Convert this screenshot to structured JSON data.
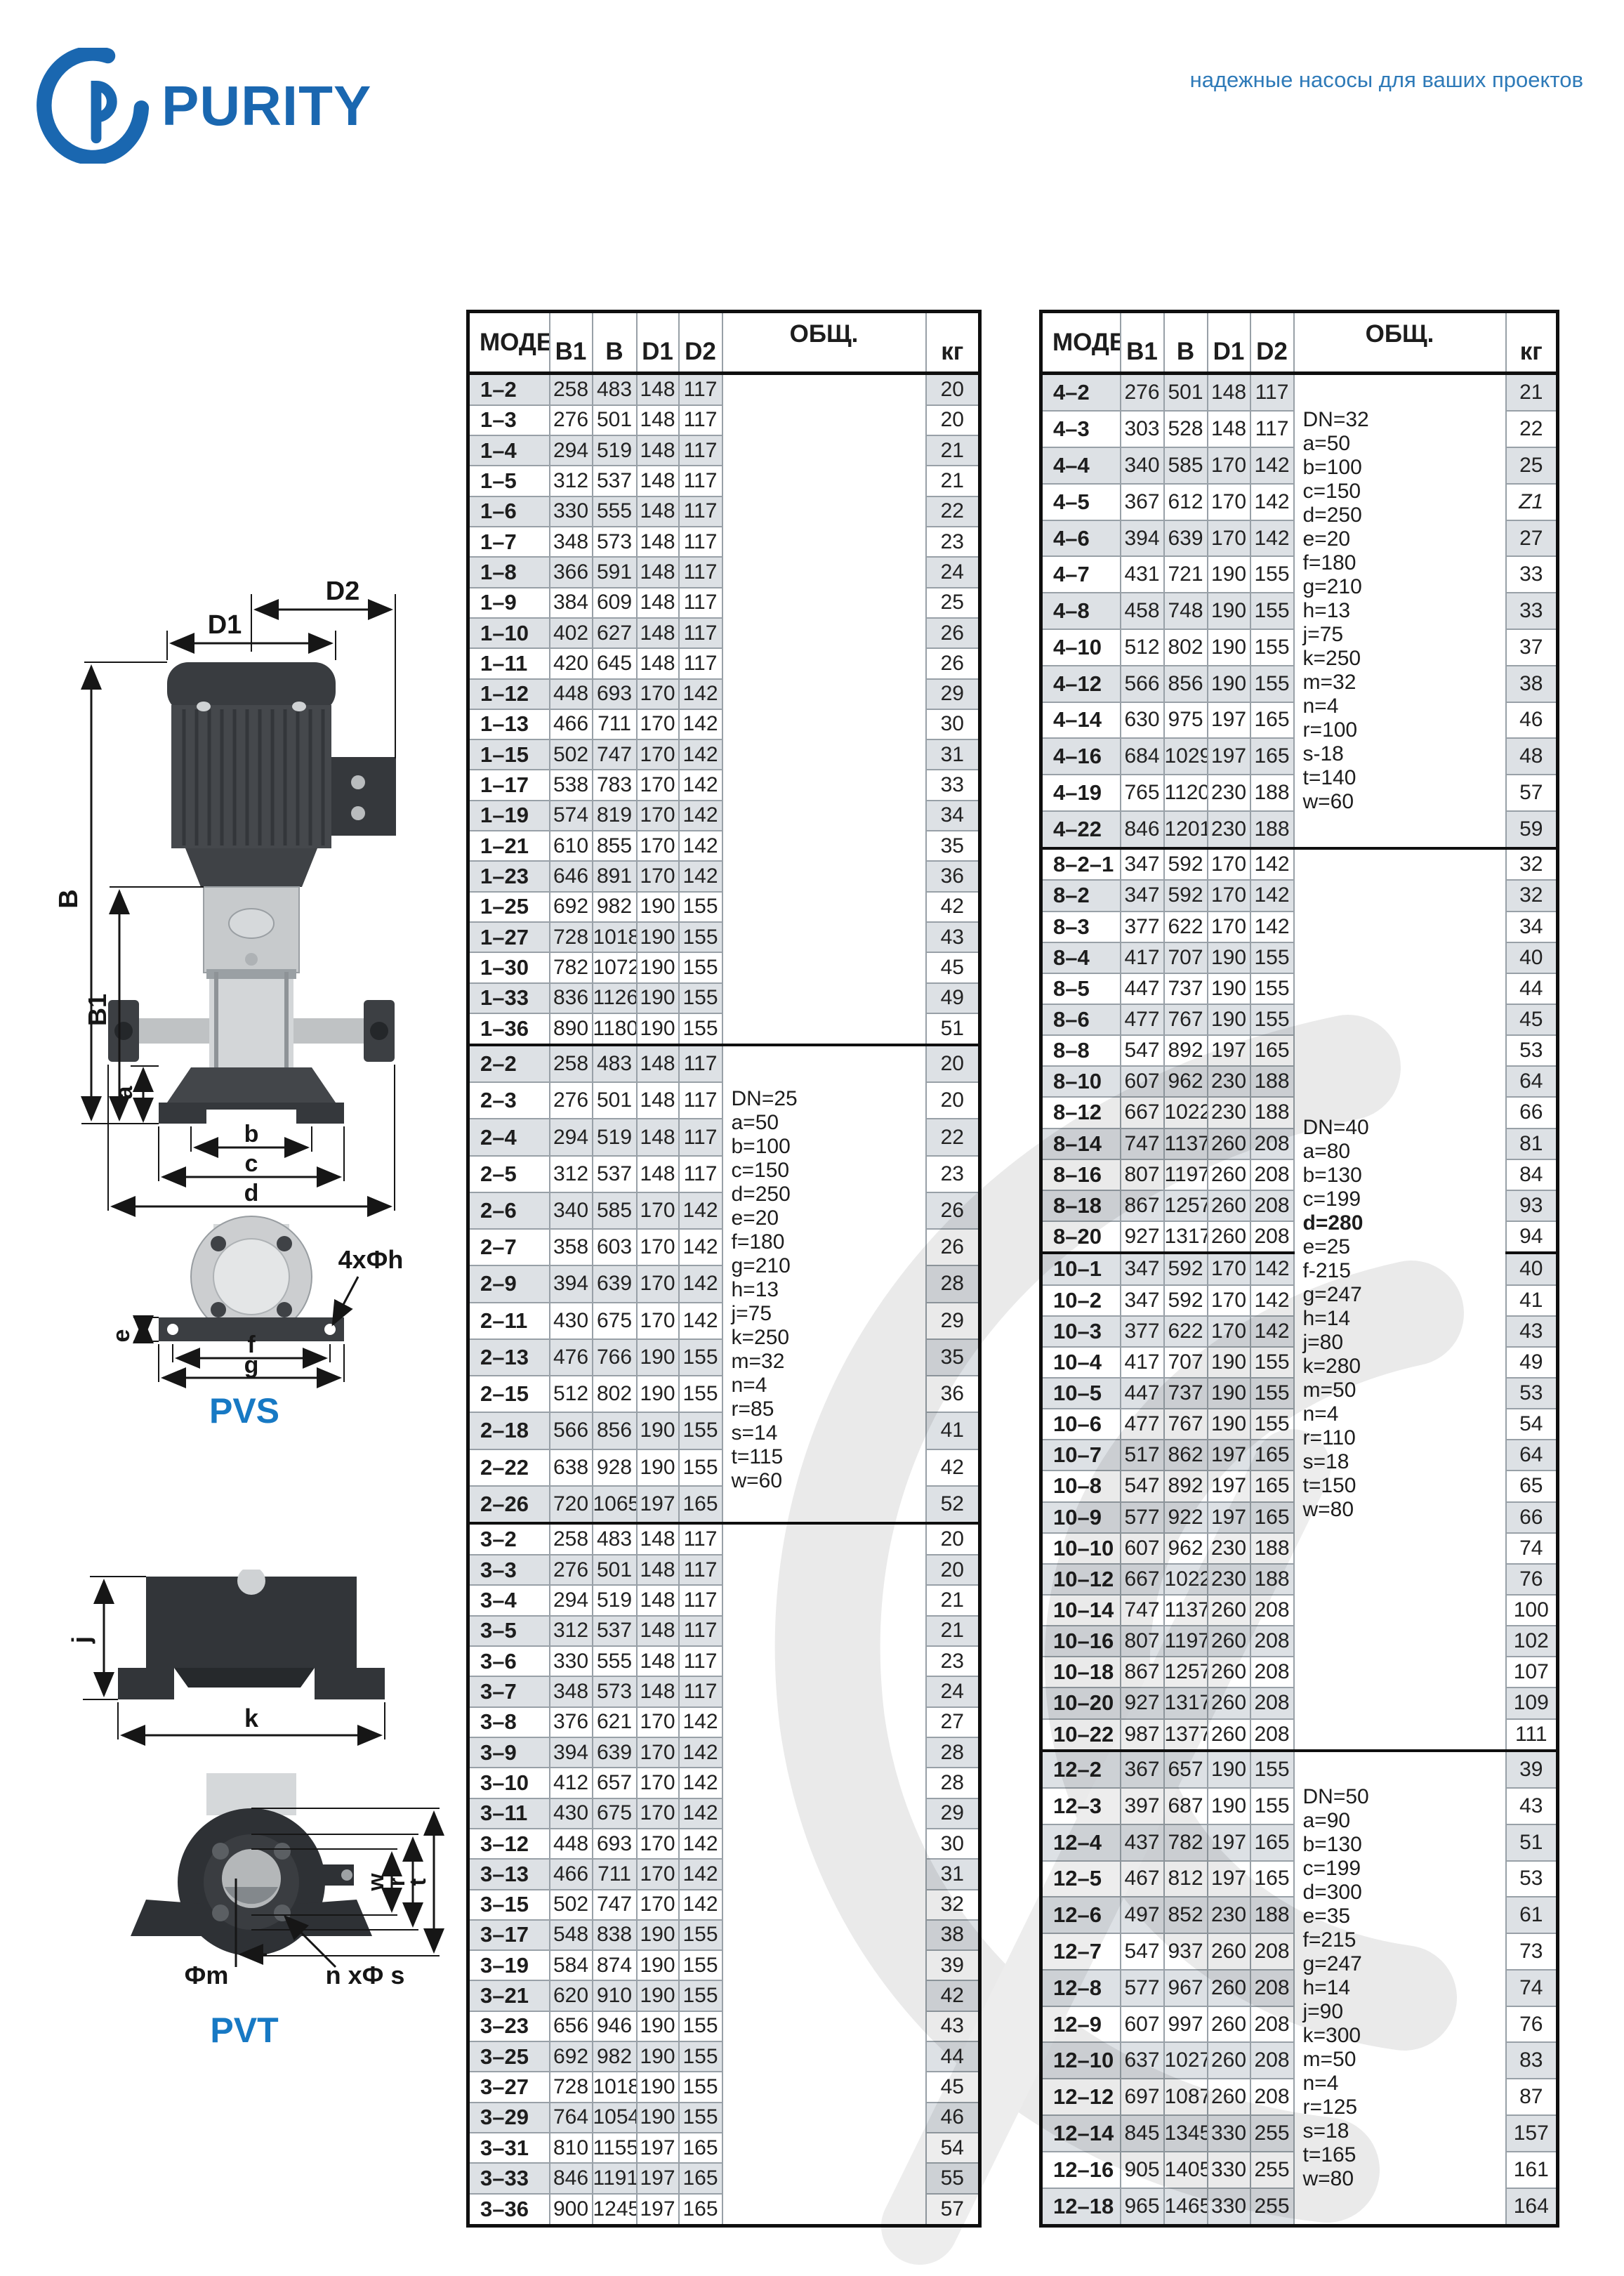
{
  "page": {
    "brand": "PURITY",
    "tagline": "надежные насосы для ваших проектов"
  },
  "diagram_labels": {
    "D1": "D1",
    "D2": "D2",
    "B": "B",
    "B1": "B1",
    "a": "a",
    "b": "b",
    "c": "c",
    "d": "d",
    "e": "e",
    "f": "f",
    "g": "g",
    "holes": "4xФh",
    "j": "j",
    "k": "k",
    "m": "Фm",
    "ns": "n xФ s",
    "w": "w",
    "r": "r",
    "t": "t",
    "pvs": "PVS",
    "pvt": "PVT"
  },
  "table_headers": {
    "model": "МОДЕЛЬ",
    "b1": "B1",
    "b": "B",
    "d1": "D1",
    "d2": "D2",
    "obsh": "ОБЩ.",
    "kg": "кг"
  },
  "left_table": {
    "groups": [
      {
        "rows": [
          [
            "1–2",
            "258",
            "483",
            "148",
            "117",
            "20"
          ],
          [
            "1–3",
            "276",
            "501",
            "148",
            "117",
            "20"
          ],
          [
            "1–4",
            "294",
            "519",
            "148",
            "117",
            "21"
          ],
          [
            "1–5",
            "312",
            "537",
            "148",
            "117",
            "21"
          ],
          [
            "1–6",
            "330",
            "555",
            "148",
            "117",
            "22"
          ],
          [
            "1–7",
            "348",
            "573",
            "148",
            "117",
            "23"
          ],
          [
            "1–8",
            "366",
            "591",
            "148",
            "117",
            "24"
          ],
          [
            "1–9",
            "384",
            "609",
            "148",
            "117",
            "25"
          ],
          [
            "1–10",
            "402",
            "627",
            "148",
            "117",
            "26"
          ],
          [
            "1–11",
            "420",
            "645",
            "148",
            "117",
            "26"
          ],
          [
            "1–12",
            "448",
            "693",
            "170",
            "142",
            "29"
          ],
          [
            "1–13",
            "466",
            "711",
            "170",
            "142",
            "30"
          ],
          [
            "1–15",
            "502",
            "747",
            "170",
            "142",
            "31"
          ],
          [
            "1–17",
            "538",
            "783",
            "170",
            "142",
            "33"
          ],
          [
            "1–19",
            "574",
            "819",
            "170",
            "142",
            "34"
          ],
          [
            "1–21",
            "610",
            "855",
            "170",
            "142",
            "35"
          ],
          [
            "1–23",
            "646",
            "891",
            "170",
            "142",
            "36"
          ],
          [
            "1–25",
            "692",
            "982",
            "190",
            "155",
            "42"
          ],
          [
            "1–27",
            "728",
            "1018",
            "190",
            "155",
            "43"
          ],
          [
            "1–30",
            "782",
            "1072",
            "190",
            "155",
            "45"
          ],
          [
            "1–33",
            "836",
            "1126",
            "190",
            "155",
            "49"
          ],
          [
            "1–36",
            "890",
            "1180",
            "190",
            "155",
            "51"
          ]
        ]
      },
      {
        "rows": [
          [
            "2–2",
            "258",
            "483",
            "148",
            "117",
            "20"
          ],
          [
            "2–3",
            "276",
            "501",
            "148",
            "117",
            "20"
          ],
          [
            "2–4",
            "294",
            "519",
            "148",
            "117",
            "22"
          ],
          [
            "2–5",
            "312",
            "537",
            "148",
            "117",
            "23"
          ],
          [
            "2–6",
            "340",
            "585",
            "170",
            "142",
            "26"
          ],
          [
            "2–7",
            "358",
            "603",
            "170",
            "142",
            "26"
          ],
          [
            "2–9",
            "394",
            "639",
            "170",
            "142",
            "28"
          ],
          [
            "2–11",
            "430",
            "675",
            "170",
            "142",
            "29"
          ],
          [
            "2–13",
            "476",
            "766",
            "190",
            "155",
            "35"
          ],
          [
            "2–15",
            "512",
            "802",
            "190",
            "155",
            "36"
          ],
          [
            "2–18",
            "566",
            "856",
            "190",
            "155",
            "41"
          ],
          [
            "2–22",
            "638",
            "928",
            "190",
            "155",
            "42"
          ],
          [
            "2–26",
            "720",
            "1065",
            "197",
            "165",
            "52"
          ]
        ]
      },
      {
        "rows": [
          [
            "3–2",
            "258",
            "483",
            "148",
            "117",
            "20"
          ],
          [
            "3–3",
            "276",
            "501",
            "148",
            "117",
            "20"
          ],
          [
            "3–4",
            "294",
            "519",
            "148",
            "117",
            "21"
          ],
          [
            "3–5",
            "312",
            "537",
            "148",
            "117",
            "21"
          ],
          [
            "3–6",
            "330",
            "555",
            "148",
            "117",
            "23"
          ],
          [
            "3–7",
            "348",
            "573",
            "148",
            "117",
            "24"
          ],
          [
            "3–8",
            "376",
            "621",
            "170",
            "142",
            "27"
          ],
          [
            "3–9",
            "394",
            "639",
            "170",
            "142",
            "28"
          ],
          [
            "3–10",
            "412",
            "657",
            "170",
            "142",
            "28"
          ],
          [
            "3–11",
            "430",
            "675",
            "170",
            "142",
            "29"
          ],
          [
            "3–12",
            "448",
            "693",
            "170",
            "142",
            "30"
          ],
          [
            "3–13",
            "466",
            "711",
            "170",
            "142",
            "31"
          ],
          [
            "3–15",
            "502",
            "747",
            "170",
            "142",
            "32"
          ],
          [
            "3–17",
            "548",
            "838",
            "190",
            "155",
            "38"
          ],
          [
            "3–19",
            "584",
            "874",
            "190",
            "155",
            "39"
          ],
          [
            "3–21",
            "620",
            "910",
            "190",
            "155",
            "42"
          ],
          [
            "3–23",
            "656",
            "946",
            "190",
            "155",
            "43"
          ],
          [
            "3–25",
            "692",
            "982",
            "190",
            "155",
            "44"
          ],
          [
            "3–27",
            "728",
            "1018",
            "190",
            "155",
            "45"
          ],
          [
            "3–29",
            "764",
            "1054",
            "190",
            "155",
            "46"
          ],
          [
            "3–31",
            "810",
            "1155",
            "197",
            "165",
            "54"
          ],
          [
            "3–33",
            "846",
            "1191",
            "197",
            "165",
            "55"
          ],
          [
            "3–36",
            "900",
            "1245",
            "197",
            "165",
            "57"
          ]
        ]
      }
    ],
    "note_spans": [
      {
        "group_start": 0,
        "group_end": 0,
        "lines": [],
        "bold": [],
        "pad_top": 0
      },
      {
        "group_start": 1,
        "group_end": 1,
        "pad_top": 16,
        "bold": [],
        "lines": [
          "DN=25",
          "a=50",
          "b=100",
          "c=150",
          "d=250",
          "e=20",
          "f=180",
          "g=210",
          "h=13",
          "j=75",
          "k=250",
          "m=32",
          "n=4",
          "r=85",
          "s=14",
          "t=115",
          "w=60"
        ]
      },
      {
        "group_start": 2,
        "group_end": 2,
        "lines": [],
        "bold": [],
        "pad_top": 0
      }
    ]
  },
  "right_table": {
    "groups": [
      {
        "rows": [
          [
            "4–2",
            "276",
            "501",
            "148",
            "117",
            "21"
          ],
          [
            "4–3",
            "303",
            "528",
            "148",
            "117",
            "22"
          ],
          [
            "4–4",
            "340",
            "585",
            "170",
            "142",
            "25"
          ],
          [
            "4–5",
            "367",
            "612",
            "170",
            "142",
            "Z1"
          ],
          [
            "4–6",
            "394",
            "639",
            "170",
            "142",
            "27"
          ],
          [
            "4–7",
            "431",
            "721",
            "190",
            "155",
            "33"
          ],
          [
            "4–8",
            "458",
            "748",
            "190",
            "155",
            "33"
          ],
          [
            "4–10",
            "512",
            "802",
            "190",
            "155",
            "37"
          ],
          [
            "4–12",
            "566",
            "856",
            "190",
            "155",
            "38"
          ],
          [
            "4–14",
            "630",
            "975",
            "197",
            "165",
            "46"
          ],
          [
            "4–16",
            "684",
            "1029",
            "197",
            "165",
            "48"
          ],
          [
            "4–19",
            "765",
            "1120",
            "230",
            "188",
            "57"
          ],
          [
            "4–22",
            "846",
            "1201",
            "230",
            "188",
            "59"
          ]
        ]
      },
      {
        "rows": [
          [
            "8–2–1",
            "347",
            "592",
            "170",
            "142",
            "32"
          ],
          [
            "8–2",
            "347",
            "592",
            "170",
            "142",
            "32"
          ],
          [
            "8–3",
            "377",
            "622",
            "170",
            "142",
            "34"
          ],
          [
            "8–4",
            "417",
            "707",
            "190",
            "155",
            "40"
          ],
          [
            "8–5",
            "447",
            "737",
            "190",
            "155",
            "44"
          ],
          [
            "8–6",
            "477",
            "767",
            "190",
            "155",
            "45"
          ],
          [
            "8–8",
            "547",
            "892",
            "197",
            "165",
            "53"
          ],
          [
            "8–10",
            "607",
            "962",
            "230",
            "188",
            "64"
          ],
          [
            "8–12",
            "667",
            "1022",
            "230",
            "188",
            "66"
          ],
          [
            "8–14",
            "747",
            "1137",
            "260",
            "208",
            "81"
          ],
          [
            "8–16",
            "807",
            "1197",
            "260",
            "208",
            "84"
          ],
          [
            "8–18",
            "867",
            "1257",
            "260",
            "208",
            "93"
          ],
          [
            "8–20",
            "927",
            "1317",
            "260",
            "208",
            "94"
          ]
        ]
      },
      {
        "rows": [
          [
            "10–1",
            "347",
            "592",
            "170",
            "142",
            "40"
          ],
          [
            "10–2",
            "347",
            "592",
            "170",
            "142",
            "41"
          ],
          [
            "10–3",
            "377",
            "622",
            "170",
            "142",
            "43"
          ],
          [
            "10–4",
            "417",
            "707",
            "190",
            "155",
            "49"
          ],
          [
            "10–5",
            "447",
            "737",
            "190",
            "155",
            "53"
          ],
          [
            "10–6",
            "477",
            "767",
            "190",
            "155",
            "54"
          ],
          [
            "10–7",
            "517",
            "862",
            "197",
            "165",
            "64"
          ],
          [
            "10–8",
            "547",
            "892",
            "197",
            "165",
            "65"
          ],
          [
            "10–9",
            "577",
            "922",
            "197",
            "165",
            "66"
          ],
          [
            "10–10",
            "607",
            "962",
            "230",
            "188",
            "74"
          ],
          [
            "10–12",
            "667",
            "1022",
            "230",
            "188",
            "76"
          ],
          [
            "10–14",
            "747",
            "1137",
            "260",
            "208",
            "100"
          ],
          [
            "10–16",
            "807",
            "1197",
            "260",
            "208",
            "102"
          ],
          [
            "10–18",
            "867",
            "1257",
            "260",
            "208",
            "107"
          ],
          [
            "10–20",
            "927",
            "1317",
            "260",
            "208",
            "109"
          ],
          [
            "10–22",
            "987",
            "1377",
            "260",
            "208",
            "111"
          ]
        ]
      },
      {
        "rows": [
          [
            "12–2",
            "367",
            "657",
            "190",
            "155",
            "39"
          ],
          [
            "12–3",
            "397",
            "687",
            "190",
            "155",
            "43"
          ],
          [
            "12–4",
            "437",
            "782",
            "197",
            "165",
            "51"
          ],
          [
            "12–5",
            "467",
            "812",
            "197",
            "165",
            "53"
          ],
          [
            "12–6",
            "497",
            "852",
            "230",
            "188",
            "61"
          ],
          [
            "12–7",
            "547",
            "937",
            "260",
            "208",
            "73"
          ],
          [
            "12–8",
            "577",
            "967",
            "260",
            "208",
            "74"
          ],
          [
            "12–9",
            "607",
            "997",
            "260",
            "208",
            "76"
          ],
          [
            "12–10",
            "637",
            "1027",
            "260",
            "208",
            "83"
          ],
          [
            "12–12",
            "697",
            "1087",
            "260",
            "208",
            "87"
          ],
          [
            "12–14",
            "845",
            "1345",
            "330",
            "255",
            "157"
          ],
          [
            "12–16",
            "905",
            "1405",
            "330",
            "255",
            "161"
          ],
          [
            "12–18",
            "965",
            "1465",
            "330",
            "255",
            "164"
          ]
        ]
      }
    ],
    "note_spans": [
      {
        "group_start": 0,
        "group_end": 0,
        "pad_top": 0,
        "bold": [],
        "lines": [
          "DN=32",
          "a=50",
          "b=100",
          "c=150",
          "d=250",
          "e=20",
          "f=180",
          "g=210",
          "h=13",
          "j=75",
          "k=250",
          "m=32",
          "n=4",
          "r=100",
          "s-18",
          "t=140",
          "w=60"
        ]
      },
      {
        "group_start": 1,
        "group_end": 2,
        "pad_top": 55,
        "bold": [
          "d=280"
        ],
        "lines": [
          "DN=40",
          "a=80",
          "b=130",
          "c=199",
          "d=280",
          "e=25",
          "f-215",
          "g=247",
          "h=14",
          "j=80",
          "k=280",
          "m=50",
          "n=4",
          "r=110",
          "s=18",
          "t=150",
          "w=80"
        ]
      },
      {
        "group_start": 3,
        "group_end": 3,
        "pad_top": 0,
        "bold": [],
        "lines": [
          "DN=50",
          "a=90",
          "b=130",
          "c=199",
          "d=300",
          "e=35",
          "f=215",
          "g=247",
          "h=14",
          "j=90",
          "k=300",
          "m=50",
          "n=4",
          "r=125",
          "s=18",
          "t=165",
          "w=80"
        ]
      }
    ]
  }
}
